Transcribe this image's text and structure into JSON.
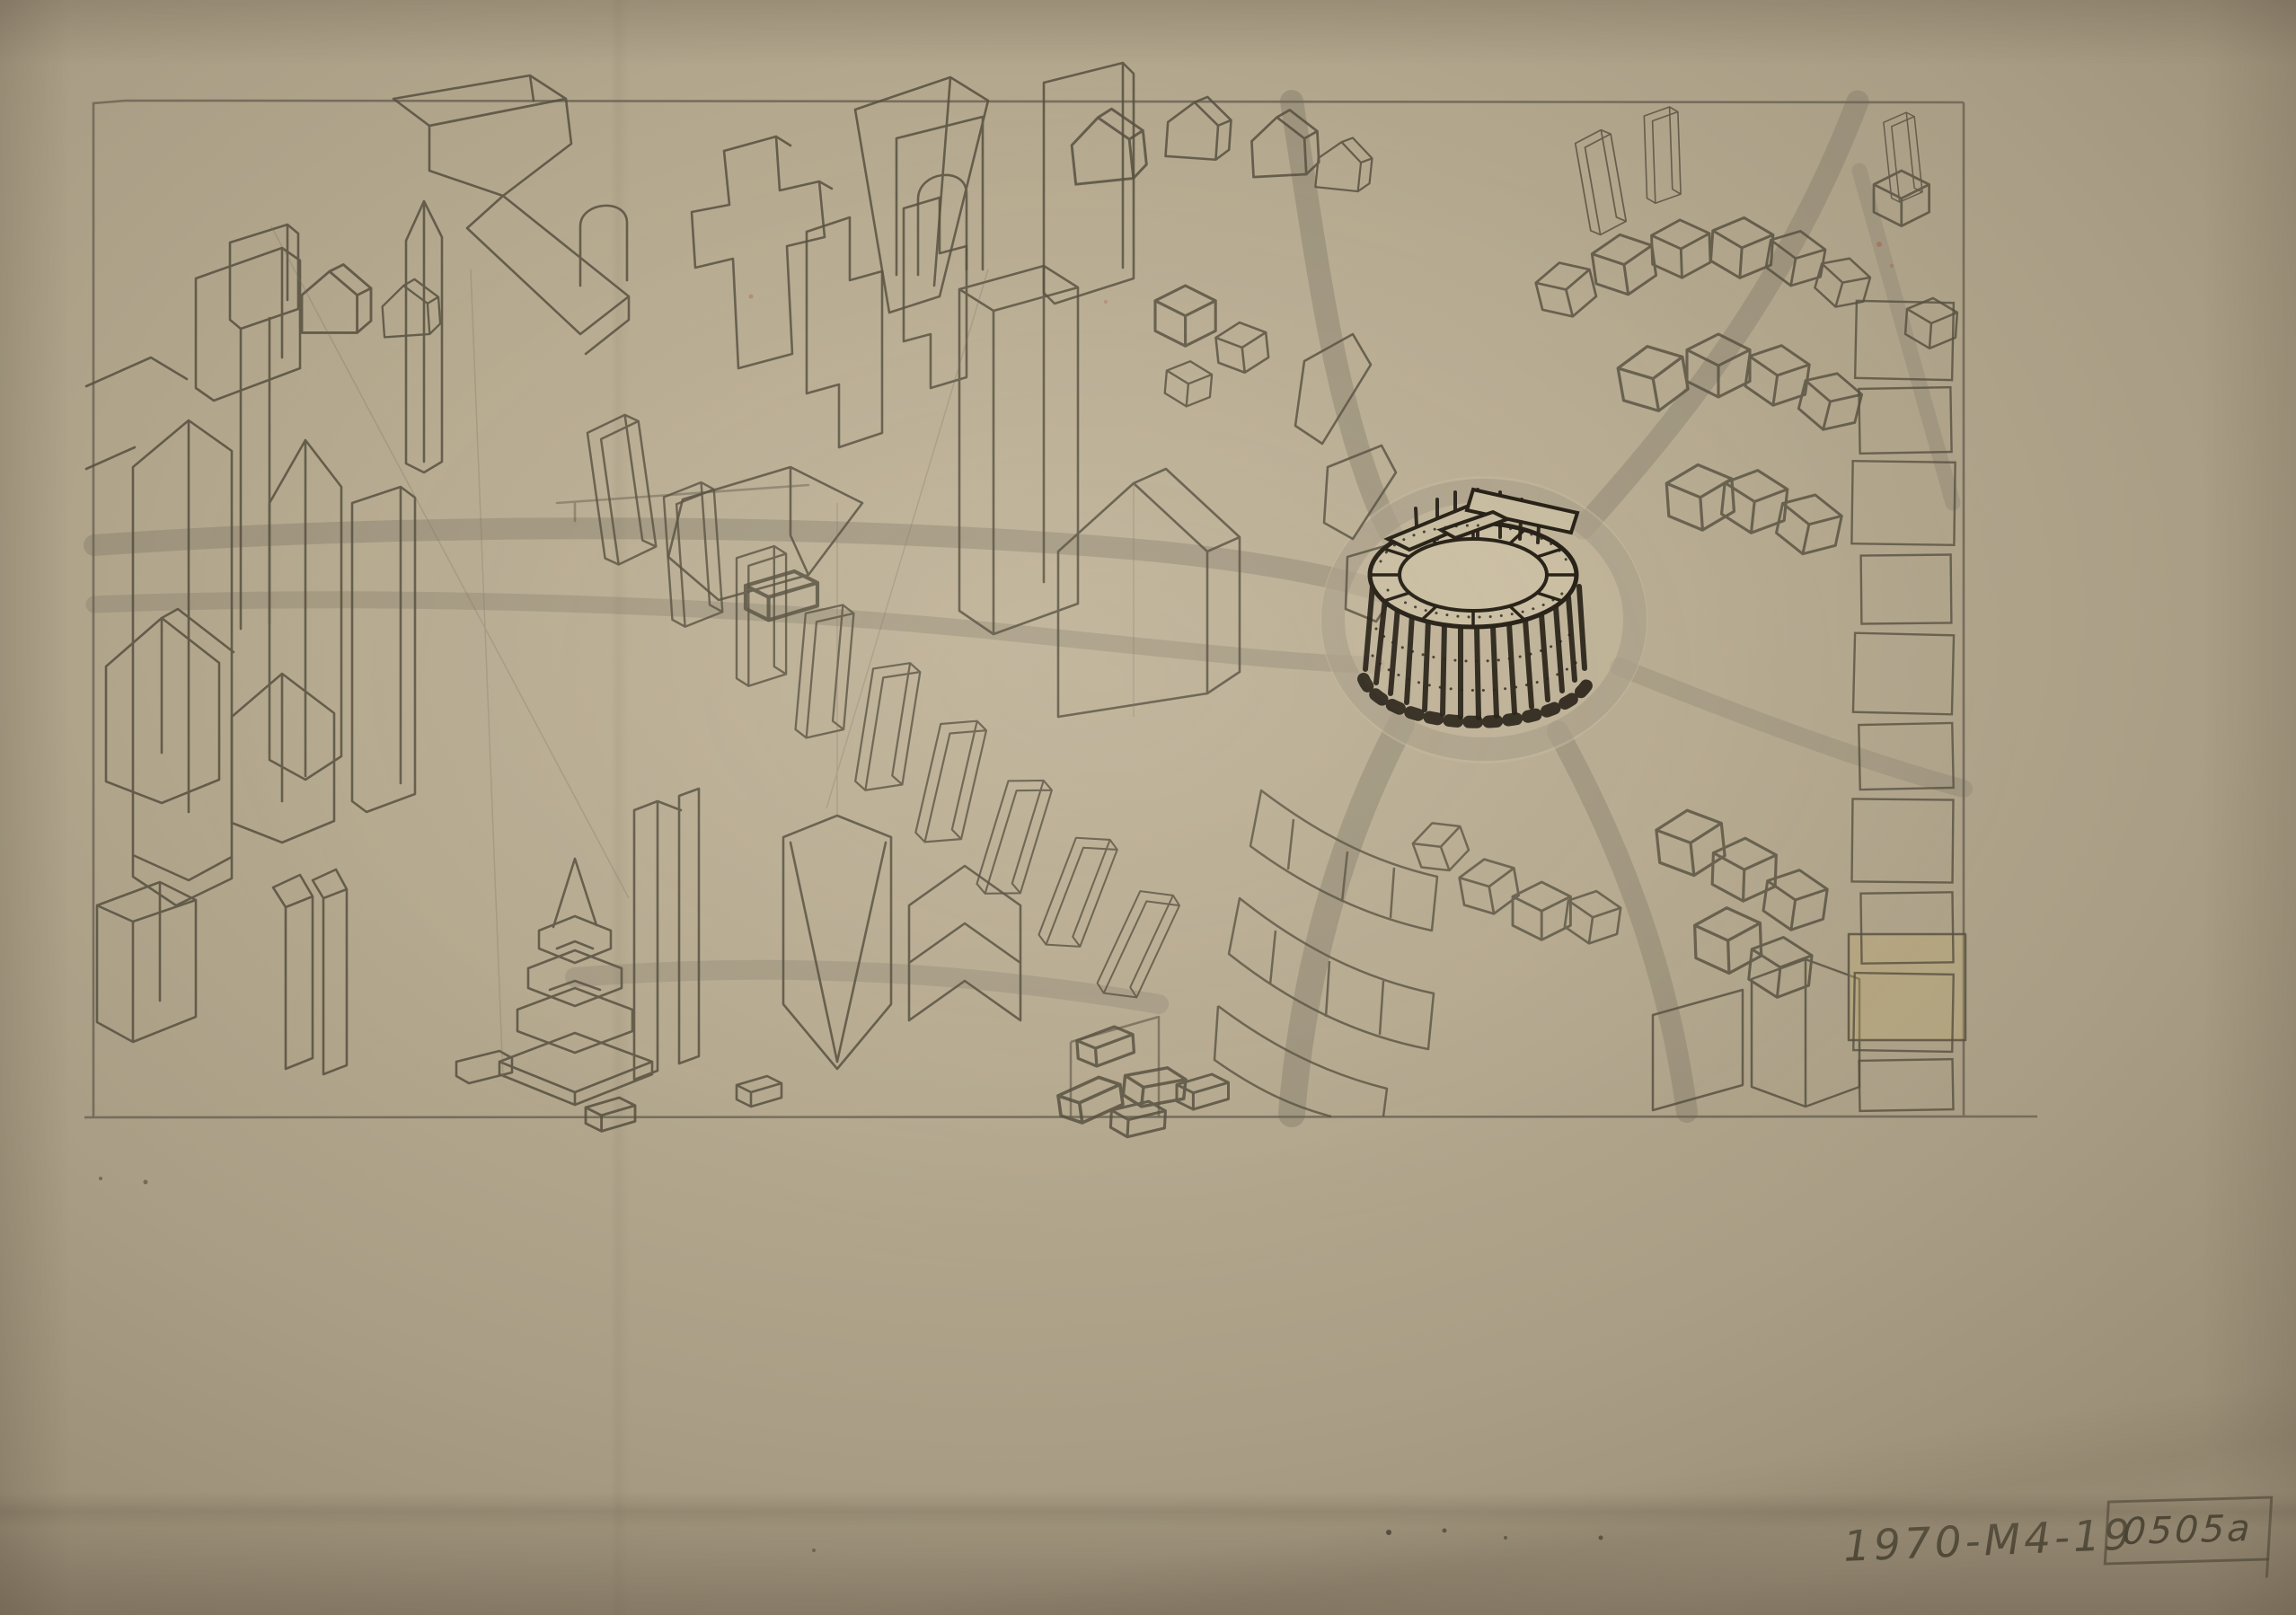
{
  "annotation": {
    "code": "1970-M4-19",
    "stamp": "0505a"
  },
  "palette": {
    "paper": "#b5a98f",
    "paper_light": "#c1b59b",
    "paper_shadow": "#998d76",
    "pencil": "#57503f",
    "pencil_faint": "#7a7260",
    "road_gray": "#7d7565",
    "ink_black": "#211b11",
    "red_fleck": "#a5503c",
    "yellow_wash": "#c4ae6c"
  }
}
